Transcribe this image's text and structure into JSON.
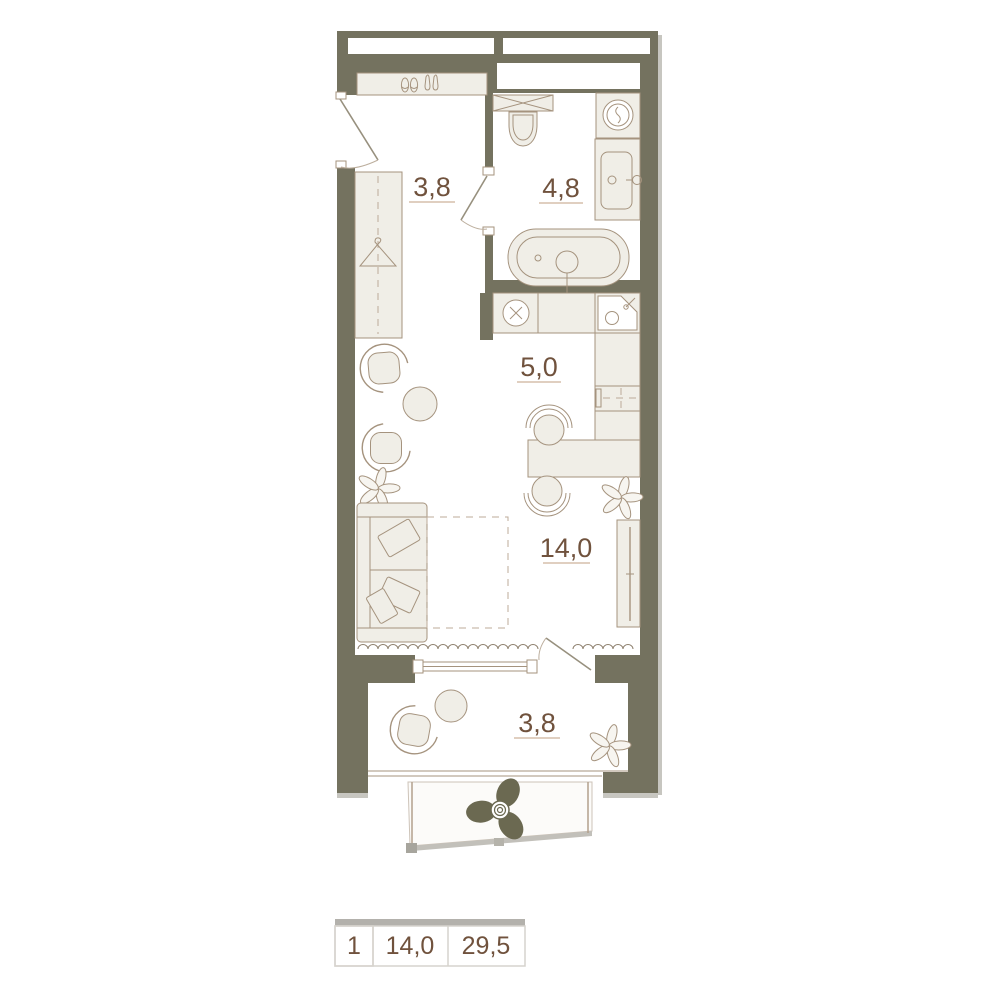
{
  "plan": {
    "rooms": {
      "hallway": {
        "label": "3,8"
      },
      "bathroom": {
        "label": "4,8"
      },
      "kitchen": {
        "label": "5,0"
      },
      "living": {
        "label": "14,0"
      },
      "balcony": {
        "label": "3,8"
      }
    },
    "legend": {
      "rooms_count": "1",
      "living_area": "14,0",
      "total_area": "29,5"
    },
    "colors": {
      "wall": "#74725f",
      "furniture_fill": "#f0eee7",
      "furniture_stroke": "#a5937e",
      "label_text": "#70523d",
      "underline": "#cdb29b",
      "fan": "#6b6951",
      "shadow": "#c7c6c0",
      "legend_bar": "#b3b1ac",
      "legend_border": "#d6d3cd",
      "legend_cell_bg": "#edebe4"
    }
  }
}
